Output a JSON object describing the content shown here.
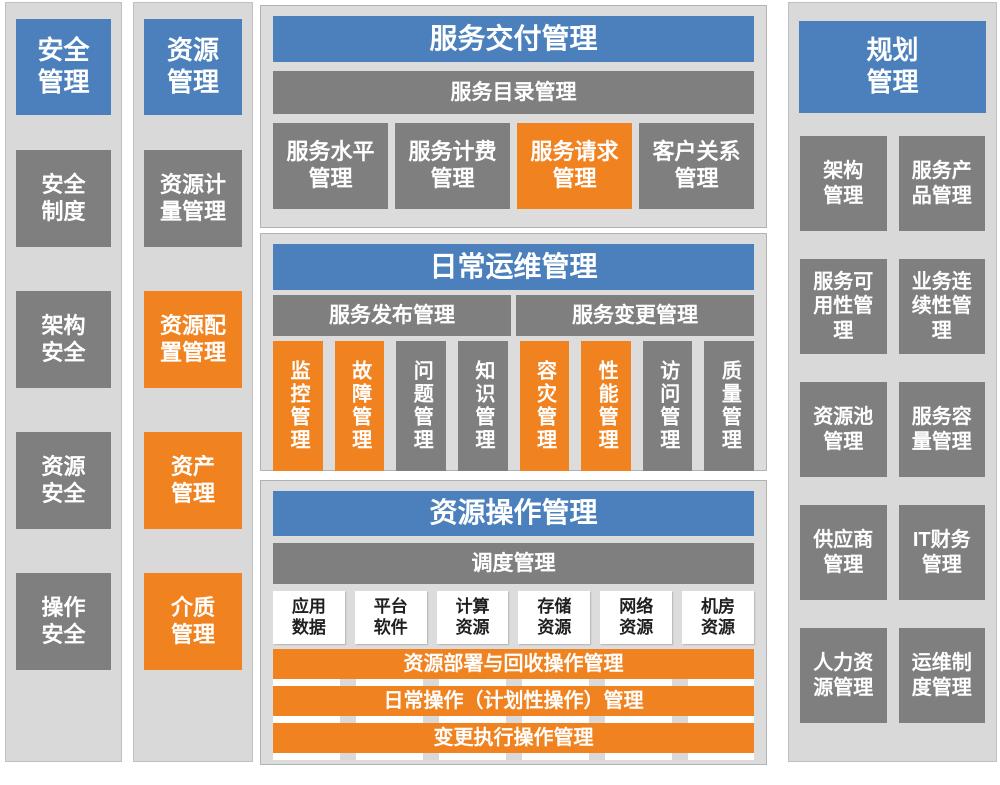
{
  "colors": {
    "header_blue": "#4b80bc",
    "box_gray": "#7f7f7f",
    "box_orange": "#f0821f",
    "panel_background": "#dcdcdc",
    "strip_background": "#d9d9d9",
    "white_box_text": "#1f1f1f"
  },
  "security_column": {
    "header": "安全\n管理",
    "items": [
      {
        "label": "安全\n制度",
        "variant": "gray"
      },
      {
        "label": "架构\n安全",
        "variant": "gray"
      },
      {
        "label": "资源\n安全",
        "variant": "gray"
      },
      {
        "label": "操作\n安全",
        "variant": "gray"
      }
    ]
  },
  "resource_column": {
    "header": "资源\n管理",
    "items": [
      {
        "label": "资源计\n量管理",
        "variant": "gray"
      },
      {
        "label": "资源配\n置管理",
        "variant": "orange"
      },
      {
        "label": "资产\n管理",
        "variant": "orange"
      },
      {
        "label": "介质\n管理",
        "variant": "orange"
      }
    ]
  },
  "service_delivery_panel": {
    "header": "服务交付管理",
    "catalog_bar": "服务目录管理",
    "boxes": [
      {
        "label": "服务水平\n管理",
        "variant": "gray"
      },
      {
        "label": "服务计费\n管理",
        "variant": "gray"
      },
      {
        "label": "服务请求\n管理",
        "variant": "orange"
      },
      {
        "label": "客户关系\n管理",
        "variant": "gray"
      }
    ]
  },
  "daily_ops_panel": {
    "header": "日常运维管理",
    "bars": [
      {
        "label": "服务发布管理"
      },
      {
        "label": "服务变更管理"
      }
    ],
    "boxes": [
      {
        "label": "监控管理",
        "variant": "orange"
      },
      {
        "label": "故障管理",
        "variant": "orange"
      },
      {
        "label": "问题管理",
        "variant": "gray"
      },
      {
        "label": "知识管理",
        "variant": "gray"
      },
      {
        "label": "容灾管理",
        "variant": "orange"
      },
      {
        "label": "性能管理",
        "variant": "orange"
      },
      {
        "label": "访问管理",
        "variant": "gray"
      },
      {
        "label": "质量管理",
        "variant": "gray"
      }
    ]
  },
  "resource_ops_panel": {
    "header": "资源操作管理",
    "scheduling_bar": "调度管理",
    "resource_boxes": [
      {
        "label": "应用\n数据"
      },
      {
        "label": "平台\n软件"
      },
      {
        "label": "计算\n资源"
      },
      {
        "label": "存储\n资源"
      },
      {
        "label": "网络\n资源"
      },
      {
        "label": "机房\n资源"
      }
    ],
    "operation_bars": [
      {
        "label": "资源部署与回收操作管理"
      },
      {
        "label": "日常操作（计划性操作）管理"
      },
      {
        "label": "变更执行操作管理"
      }
    ]
  },
  "planning_column": {
    "header": "规划\n管理",
    "items": [
      {
        "label": "架构\n管理"
      },
      {
        "label": "服务产\n品管理"
      },
      {
        "label": "服务可\n用性管\n理"
      },
      {
        "label": "业务连\n续性管\n理"
      },
      {
        "label": "资源池\n管理"
      },
      {
        "label": "服务容\n量管理"
      },
      {
        "label": "供应商\n管理"
      },
      {
        "label": "IT财务\n管理"
      },
      {
        "label": "人力资\n源管理"
      },
      {
        "label": "运维制\n度管理"
      }
    ]
  }
}
